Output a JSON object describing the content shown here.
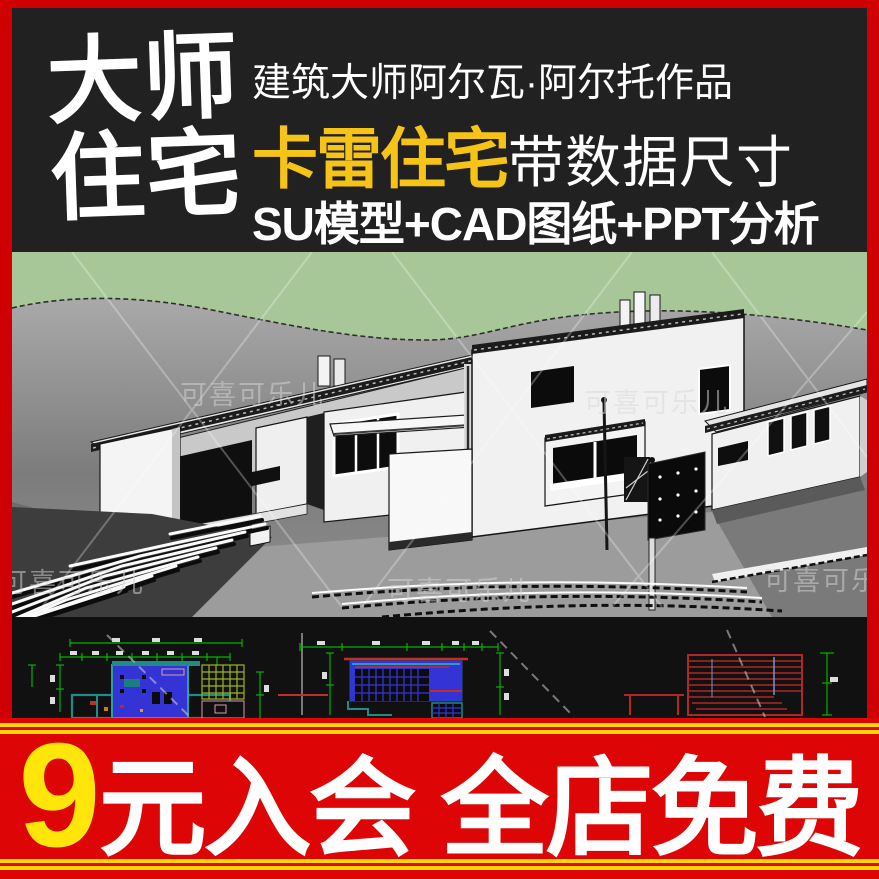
{
  "frame": {
    "border_color": "#d10000"
  },
  "header": {
    "bg_color": "#212121",
    "title_line1": "大师",
    "title_line2": "住宅",
    "subtitle": "建筑大师阿尔瓦·阿尔托作品",
    "product_name": "卡雷住宅",
    "product_name_color": "#f6c417",
    "product_suffix": "带数据尺寸",
    "features": "SU模型+CAD图纸+PPT分析"
  },
  "render": {
    "watermark": "可喜可乐儿",
    "sky_color": "#a7c799",
    "terrain_color": "#8a8a8a",
    "house_color": "#f2f2f2"
  },
  "cad": {
    "bg_color": "#111111",
    "dim_color": "#00b400",
    "wall_color": "#1f8c8a",
    "fill_color": "#3434d6",
    "grid_color": "#9cb41e",
    "line_color": "#c03028"
  },
  "banner": {
    "bg_color": "#dd0505",
    "stripe_color": "#ffd800",
    "price": "9",
    "price_color": "#ffe60a",
    "text": "元入会 全店免费",
    "text_color": "#ffffff"
  }
}
